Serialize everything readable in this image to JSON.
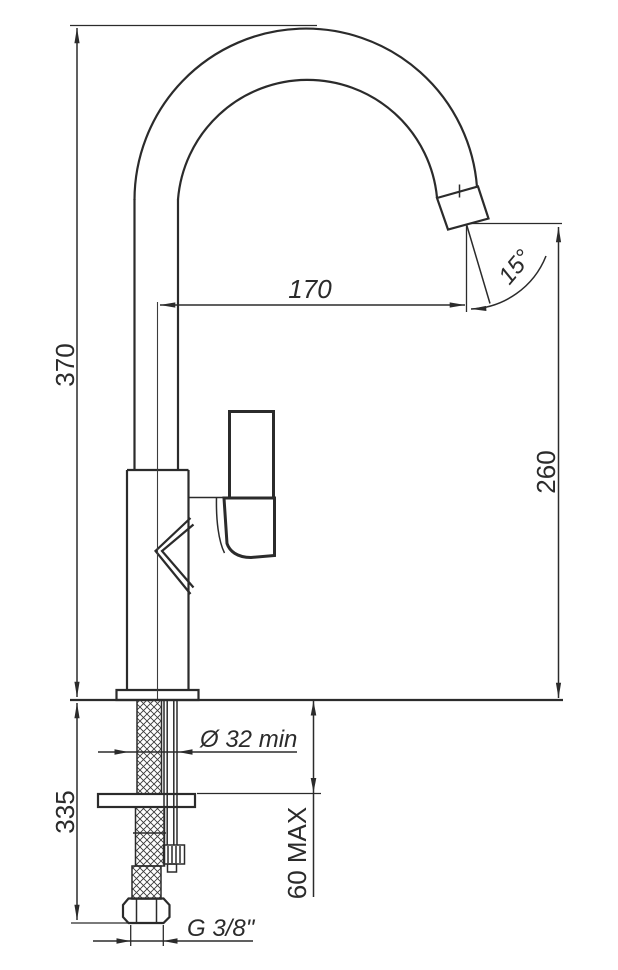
{
  "drawing": {
    "background": "#ffffff",
    "line_color": "#2b2b2b",
    "labels": {
      "overall_height": "370",
      "spout_reach": "170",
      "spout_angle": "15°",
      "spout_tip_height": "260",
      "below_counter_length": "335",
      "hole_diameter": "Ø 32 min",
      "counter_thickness_max": "60 MAX",
      "thread_size": "G 3/8\""
    }
  }
}
